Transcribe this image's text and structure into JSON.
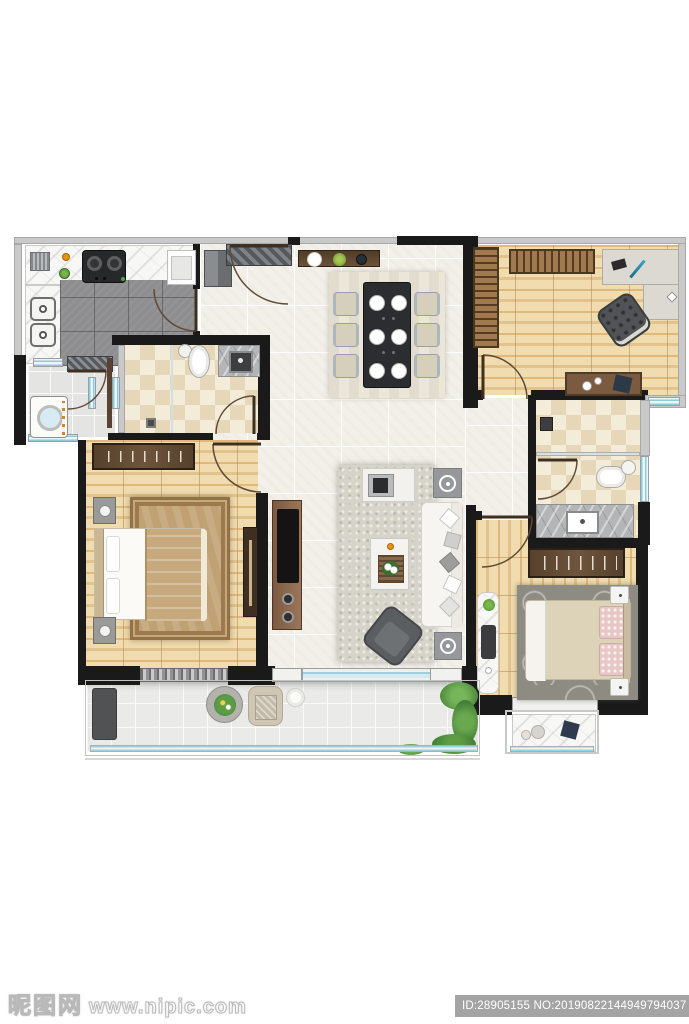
{
  "watermark": {
    "logo_text": "昵图网",
    "site_url": "www.nipic.com",
    "id_text": "ID:28905155 NO:20190822144949794037"
  },
  "palette": {
    "wall": "#1a1a1a",
    "outer_wall": "#c9c9c9",
    "floor_tile": "#f2f0e9",
    "kitchen_tile": "#8e8e91",
    "bath_tile_light": "#f3ecd9",
    "bath_tile_dark": "#e6d7b8",
    "wood_light": "#f0dcae",
    "wood_dark": "#dfb97c",
    "window_glass": "#aeddea",
    "marble_white": "#f7f7f5",
    "marble_gray": "#b4b5b7",
    "rug_living": "#d6d3c9",
    "rug_dining": "#ebe6d8",
    "rug_master": "#c0a173",
    "rug_bedroom": "#8e8b83",
    "sofa_white": "#f6f5f1",
    "armchair_gray": "#5b5e61",
    "dining_table": "#2b2d30",
    "console_wood": "#7b5a40",
    "wardrobe_wood": "#55412d",
    "balcony_tile": "#eaeae8",
    "plant_green": "#4e8a3c",
    "accent_orange": "#e8920f"
  }
}
